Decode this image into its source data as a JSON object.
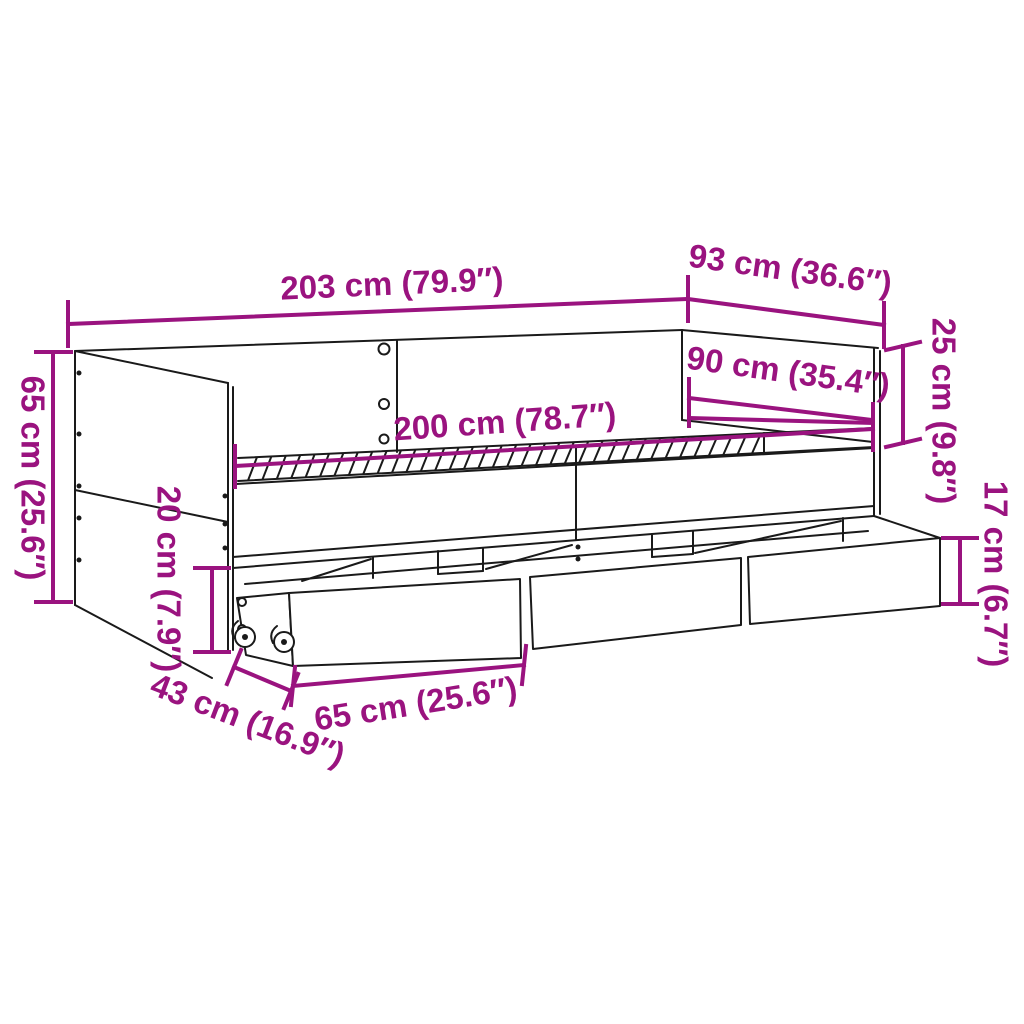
{
  "diagram": {
    "accent_color": "#9A137F",
    "outline_color": "#1A1A1A",
    "background_color": "#FFFFFF",
    "annotations": {
      "overall_length": "203 cm (79.9″)",
      "overall_depth": "93 cm (36.6″)",
      "backrest_height": "25 cm (9.8″)",
      "sleeping_width": "90 cm (35.4″)",
      "sleeping_length": "200 cm (78.7″)",
      "total_height": "65 cm (25.6″)",
      "frame_clearance_height": "20 cm (7.9″)",
      "drawer_height": "17 cm (6.7″)",
      "drawer_depth": "43 cm (16.9″)",
      "drawer_width": "65 cm (25.6″)"
    }
  }
}
